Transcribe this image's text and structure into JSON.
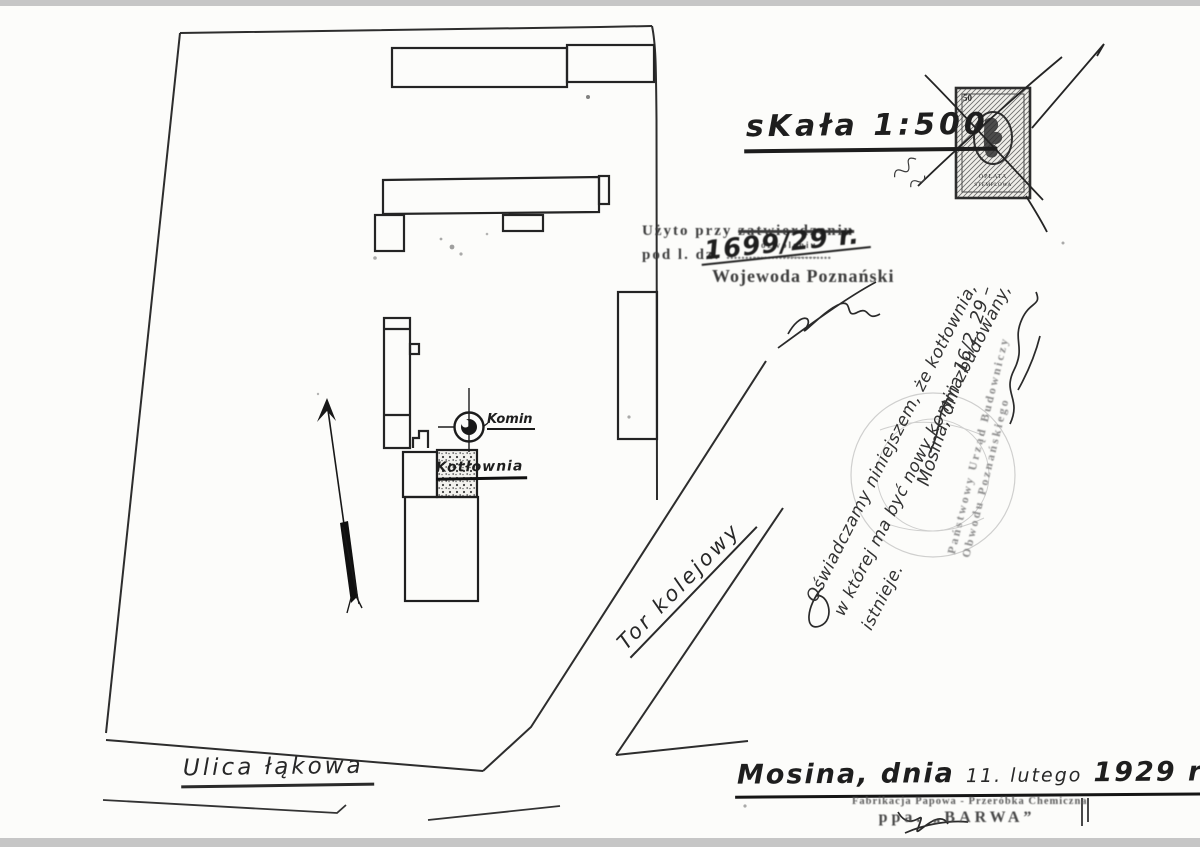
{
  "title": {
    "scale_label": "sKała 1:500"
  },
  "approval_stamp": {
    "line1_prefix": "Użyto przy",
    "line1_struck": "zatwierdzeniu",
    "line1_replacement": "pozwoleniu",
    "line2_prefix": "pod l. dz.",
    "docket_number": "1699/29 r.",
    "authority": "Wojewoda Poznański"
  },
  "handwritten_note": {
    "line1": "Oświadczamy niniejszem, że kotłownia,",
    "line2": "w której ma być nowy komin zbudowany,",
    "line3": "istnieje.",
    "dateline": "Mosina, dnia 16/2. 29 –"
  },
  "office_stamp": {
    "line1": "Państwowy Urząd Budowniczy",
    "line2": "Obwodu Poznańskiego"
  },
  "revenue_stamp": {
    "value": "50",
    "word1": "OPŁATA",
    "word2": "STEMPLOWA"
  },
  "map_labels": {
    "chimney": "Komin",
    "boiler_house": "Kotłownia",
    "railway": "Tor kolejowy",
    "street": "Ulica łąkowa"
  },
  "dateline": {
    "city": "Mosina, dnia",
    "date": "11. lutego",
    "year": "1929 r."
  },
  "company_stamp": {
    "line1": "Fabrikacja Papowa - Przeróbka Chemiczna",
    "line2": "ppa. „BARWA”"
  },
  "colors": {
    "ink": "#2b2b2b",
    "stamp_ink": "#4a4a4a",
    "paper": "#fcfcfa"
  }
}
